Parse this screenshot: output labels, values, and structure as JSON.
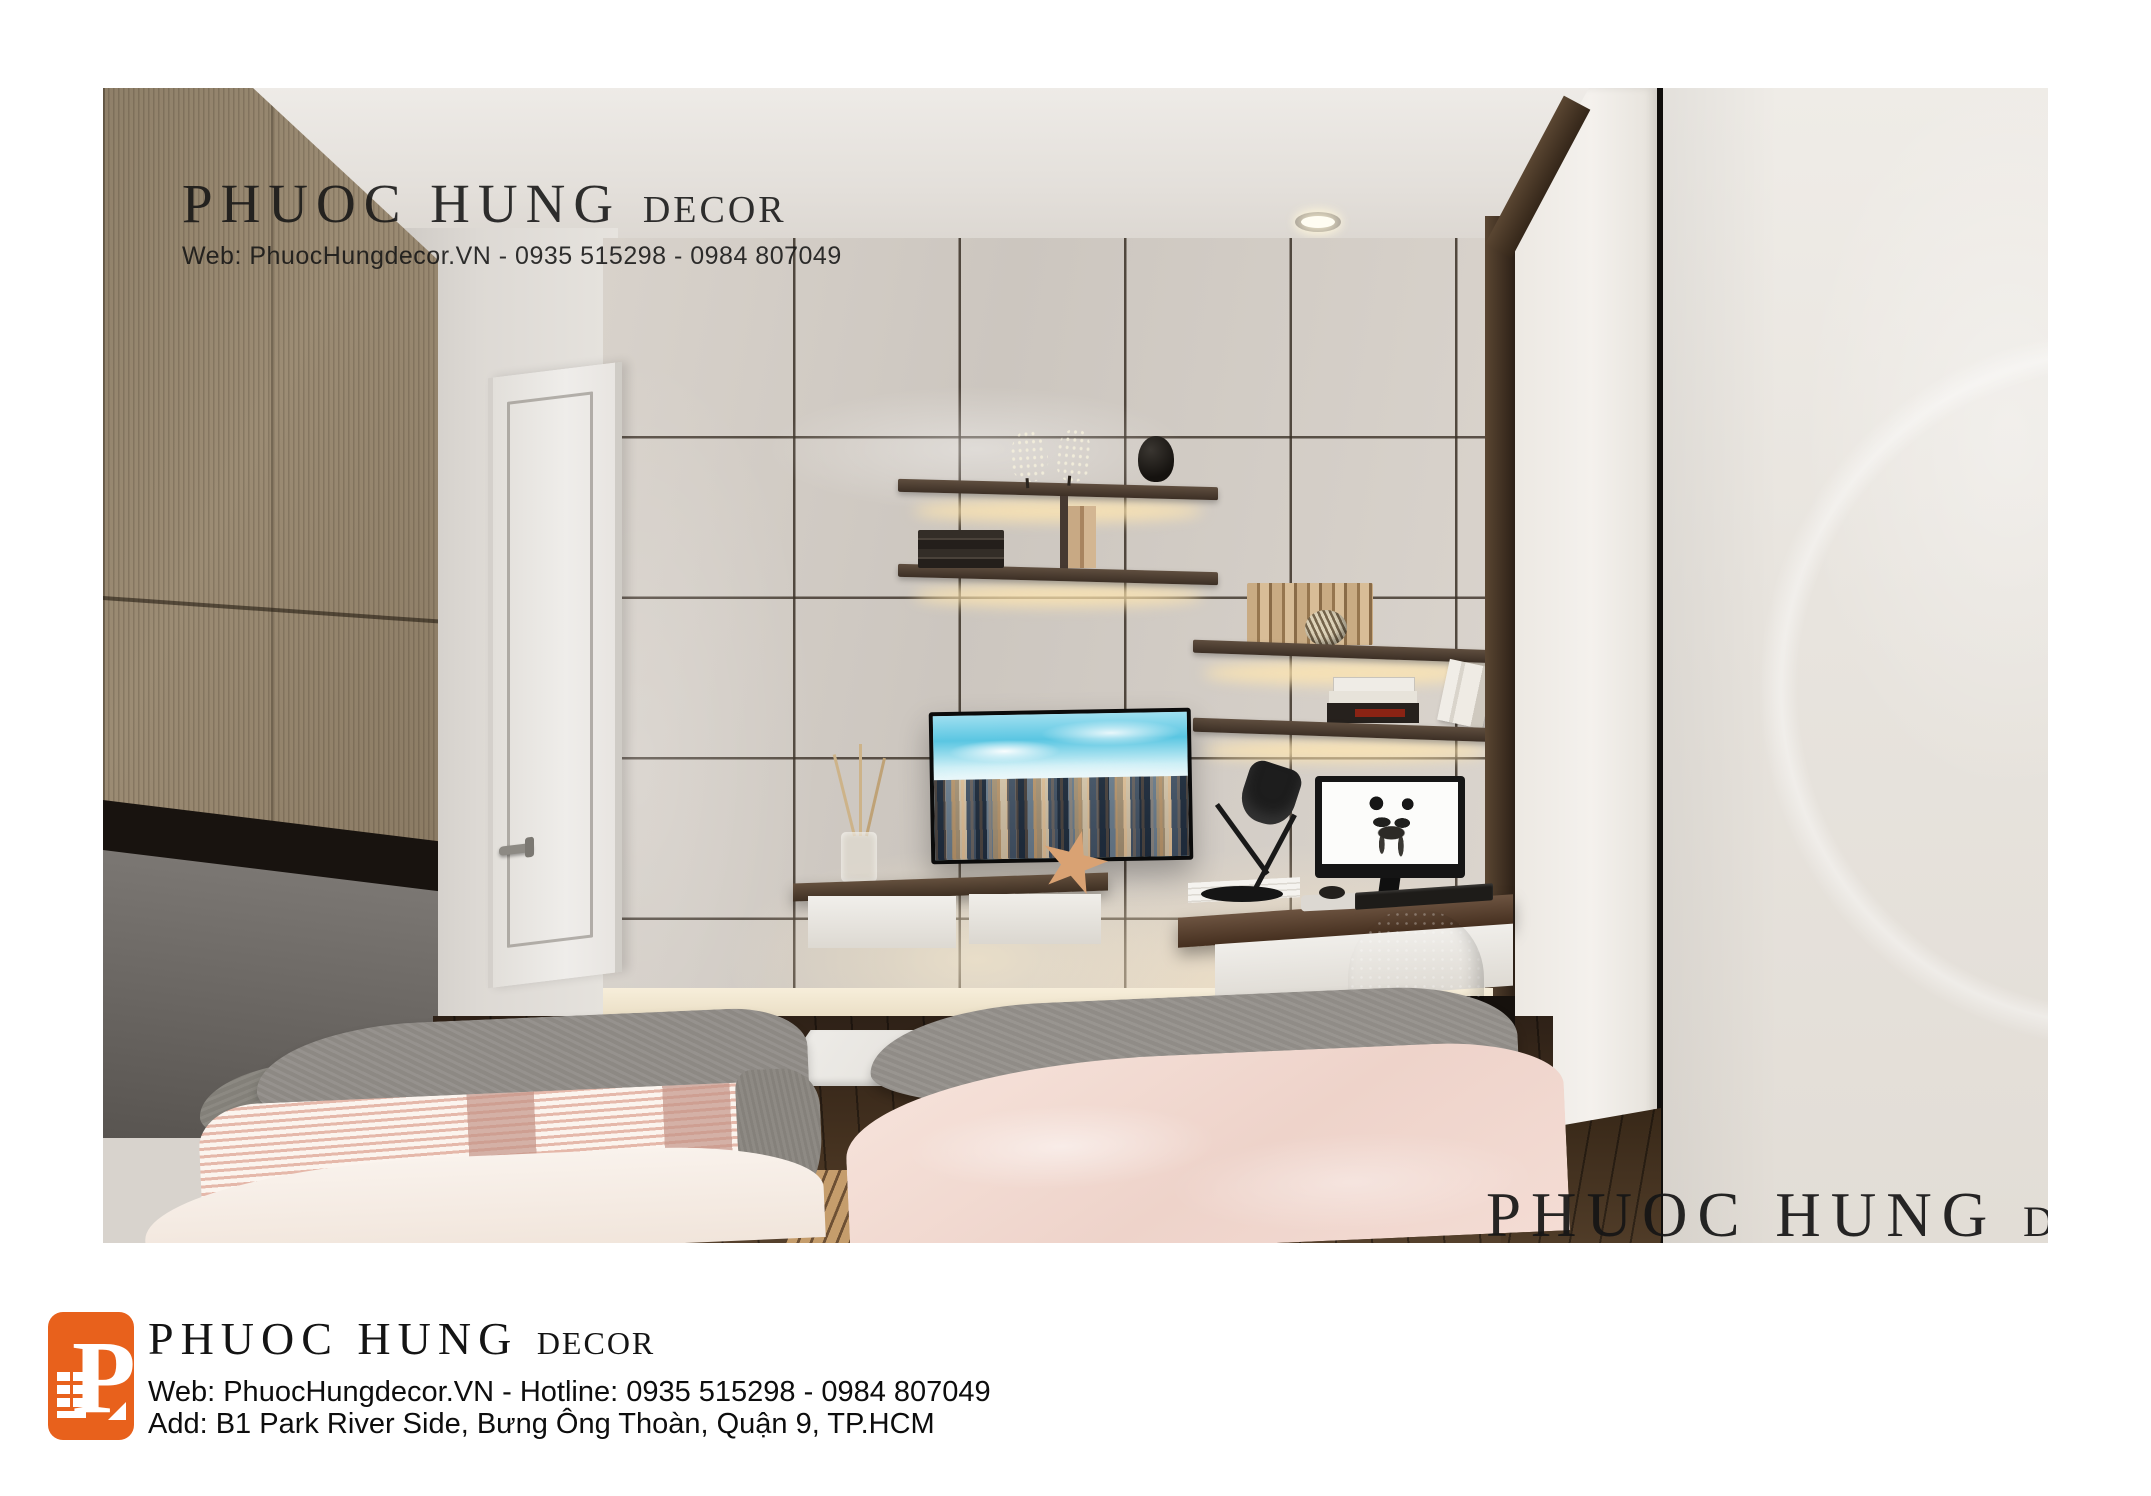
{
  "watermark_top": {
    "brand": "PHUOC HUNG",
    "brand_suffix": "DECOR",
    "contact": "Web: PhuocHungdecor.VN  -  0935 515298 - 0984 807049"
  },
  "watermark_bottom": {
    "brand": "PHUOC HUNG",
    "brand_suffix": "DECOR",
    "contact": "Web: PhuocHungdecor.VN  -  0935 515298 - 0984 807049"
  },
  "footer": {
    "brand": "PHUOC HUNG",
    "brand_suffix": "DECOR",
    "web_line": "Web: PhuocHungdecor.VN - Hotline: 0935 515298 - 0984 807049",
    "address_line": "Add: B1 Park River Side, Bưng Ông Thoàn, Quận 9, TP.HCM"
  },
  "palette": {
    "logo_orange": "#E8611C",
    "watermark_text": "#151515",
    "wall_tile": "#d3cdc6",
    "wood_dark": "#3f3023",
    "bed_pink": "#f2dad2",
    "blanket_gray": "#8d8984"
  }
}
